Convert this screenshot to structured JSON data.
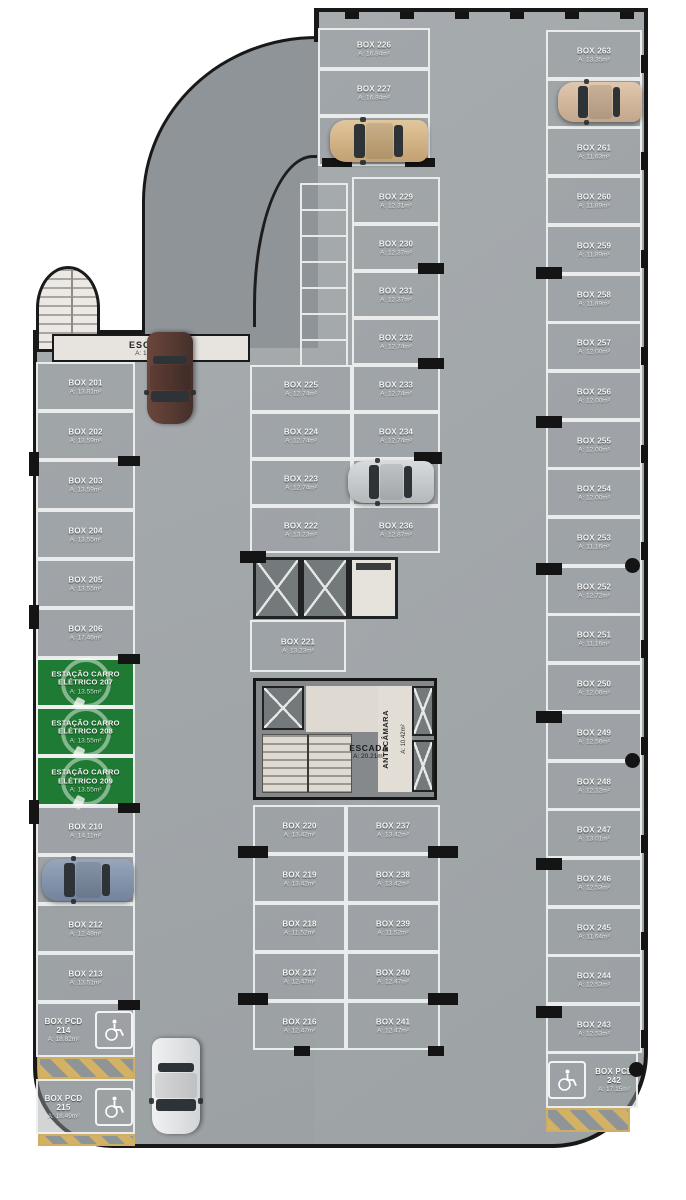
{
  "plan": {
    "stair_top_left": {
      "label": "ESCADA",
      "area": "A: 12.71m²"
    },
    "core": {
      "escada_label": "ESCADA",
      "escada_area": "A: 20.21m²",
      "antecamara_label": "ANTECÂMARA",
      "antecamara_area": "A: 10.42m²"
    },
    "colors": {
      "ev_green": "#1f7a33",
      "hatch_yellow": "#d3b266",
      "floor_gray": "#a2a7aa"
    },
    "columns": {
      "top": [
        {
          "label": "BOX 226",
          "area": "A: 16.84m²"
        },
        {
          "label": "BOX 227",
          "area": "A: 16.84m²"
        },
        {
          "label": "BOX 228",
          "area": "A: 16.84m²"
        }
      ],
      "left": [
        {
          "label": "BOX 201",
          "area": "A: 13.81m²"
        },
        {
          "label": "BOX 202",
          "area": "A: 13.59m²"
        },
        {
          "label": "BOX 203",
          "area": "A: 13.59m²"
        },
        {
          "label": "BOX 204",
          "area": "A: 13.55m²"
        },
        {
          "label": "BOX 205",
          "area": "A: 13.55m²"
        },
        {
          "label": "BOX 206",
          "area": "A: 17.46m²"
        },
        {
          "label": "ESTAÇÃO CARRO ELÉTRICO 207",
          "area": "A: 13.55m²"
        },
        {
          "label": "ESTAÇÃO CARRO ELÉTRICO 208",
          "area": "A: 13.55m²"
        },
        {
          "label": "ESTAÇÃO CARRO ELÉTRICO 209",
          "area": "A: 13.55m²"
        },
        {
          "label": "BOX 210",
          "area": "A: 14.11m²"
        },
        {
          "label": "BOX 211",
          "area": "A: 14.56m²"
        },
        {
          "label": "BOX 212",
          "area": "A: 12.48m²"
        },
        {
          "label": "BOX 213",
          "area": "A: 13.51m²"
        }
      ],
      "left_pcd": [
        {
          "label": "BOX PCD 214",
          "area": "A: 18.82m²"
        },
        {
          "label": "BOX PCD 215",
          "area": "A: 18.49m²"
        }
      ],
      "right": [
        {
          "label": "BOX 263",
          "area": "A: 13.35m²"
        },
        {
          "label": "BOX 262",
          "area": "A: 11.63m²"
        },
        {
          "label": "BOX 261",
          "area": "A: 11.63m²"
        },
        {
          "label": "BOX 260",
          "area": "A: 11.89m²"
        },
        {
          "label": "BOX 259",
          "area": "A: 11.89m²"
        },
        {
          "label": "BOX 258",
          "area": "A: 11.89m²"
        },
        {
          "label": "BOX 257",
          "area": "A: 12.00m²"
        },
        {
          "label": "BOX 256",
          "area": "A: 12.00m²"
        },
        {
          "label": "BOX 255",
          "area": "A: 12.00m²"
        },
        {
          "label": "BOX 254",
          "area": "A: 12.00m²"
        },
        {
          "label": "BOX 253",
          "area": "A: 11.16m²"
        },
        {
          "label": "BOX 252",
          "area": "A: 12.72m²"
        },
        {
          "label": "BOX 251",
          "area": "A: 11.16m²"
        },
        {
          "label": "BOX 250",
          "area": "A: 12.06m²"
        },
        {
          "label": "BOX 249",
          "area": "A: 12.56m²"
        },
        {
          "label": "BOX 248",
          "area": "A: 12.12m²"
        },
        {
          "label": "BOX 247",
          "area": "A: 13.01m²"
        },
        {
          "label": "BOX 246",
          "area": "A: 12.53m²"
        },
        {
          "label": "BOX 245",
          "area": "A: 11.64m²"
        },
        {
          "label": "BOX 244",
          "area": "A: 12.53m²"
        },
        {
          "label": "BOX 243",
          "area": "A: 12.53m²"
        }
      ],
      "right_pcd": [
        {
          "label": "BOX PCD 242",
          "area": "A: 17.15m²"
        }
      ],
      "mid_right": [
        {
          "label": "BOX 229",
          "area": "A: 12.31m²"
        },
        {
          "label": "BOX 230",
          "area": "A: 12.37m²"
        },
        {
          "label": "BOX 231",
          "area": "A: 12.37m²"
        },
        {
          "label": "BOX 232",
          "area": "A: 12.74m²"
        },
        {
          "label": "BOX 233",
          "area": "A: 12.74m²"
        },
        {
          "label": "BOX 234",
          "area": "A: 12.74m²"
        },
        {
          "label": "BOX 235",
          "area": "A: 12.74m²"
        },
        {
          "label": "BOX 236",
          "area": "A: 12.87m²"
        }
      ],
      "mid_left": [
        {
          "label": "BOX 225",
          "area": "A: 12.74m²"
        },
        {
          "label": "BOX 224",
          "area": "A: 12.74m²"
        },
        {
          "label": "BOX 223",
          "area": "A: 12.74m²"
        },
        {
          "label": "BOX 222",
          "area": "A: 13.23m²"
        }
      ],
      "box221": [
        {
          "label": "BOX 221",
          "area": "A: 13.23m²"
        }
      ],
      "bottom_left": [
        {
          "label": "BOX 220",
          "area": "A: 13.42m²"
        },
        {
          "label": "BOX 219",
          "area": "A: 13.42m²"
        },
        {
          "label": "BOX 218",
          "area": "A: 11.52m²"
        },
        {
          "label": "BOX 217",
          "area": "A: 12.47m²"
        },
        {
          "label": "BOX 216",
          "area": "A: 12.47m²"
        }
      ],
      "bottom_right": [
        {
          "label": "BOX 237",
          "area": "A: 13.42m²"
        },
        {
          "label": "BOX 238",
          "area": "A: 13.42m²"
        },
        {
          "label": "BOX 239",
          "area": "A: 11.52m²"
        },
        {
          "label": "BOX 240",
          "area": "A: 12.47m²"
        },
        {
          "label": "BOX 241",
          "area": "A: 12.47m²"
        }
      ]
    }
  }
}
